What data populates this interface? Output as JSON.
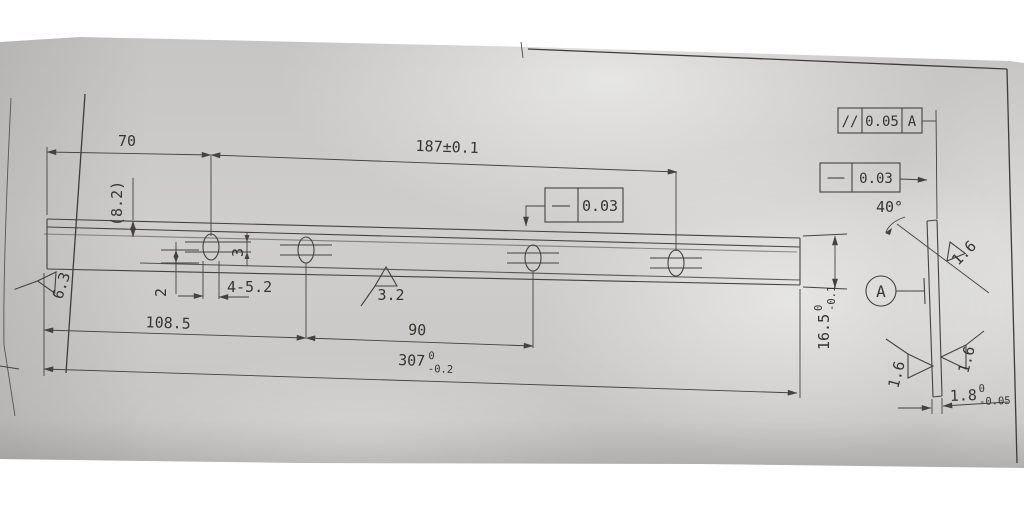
{
  "colors": {
    "background": "#ffffff",
    "paper": "#c9c8c6",
    "ink": "#45423e"
  },
  "front_view": {
    "dim_70": "70",
    "dim_187": "187±0.1",
    "dim_8_2": "(8.2)",
    "dim_2": "2",
    "dim_3": "3",
    "dim_slots": "4-5.2",
    "dim_108_5": "108.5",
    "dim_90": "90",
    "dim_307": {
      "value": "307",
      "upper": "0",
      "lower": "-0.2"
    },
    "dim_16_5": {
      "value": "16.5",
      "upper": "0",
      "lower": "-0.1"
    },
    "roughness_left_end": "6.3",
    "roughness_edge": "3.2",
    "fcf_straightness": {
      "symbol": "—",
      "tolerance": "0.03"
    }
  },
  "side_view": {
    "fcf_parallelism": {
      "symbol": "//",
      "tolerance": "0.05",
      "datum": "A"
    },
    "fcf_straightness": {
      "symbol": "—",
      "tolerance": "0.03"
    },
    "angle": "40°",
    "roughness_bevel": "1.6",
    "roughness_left_face": "1.6",
    "roughness_right_face": "1.6",
    "datum_label": "A",
    "dim_1_8": {
      "value": "1.8",
      "upper": "0",
      "lower": "-0.05"
    }
  }
}
